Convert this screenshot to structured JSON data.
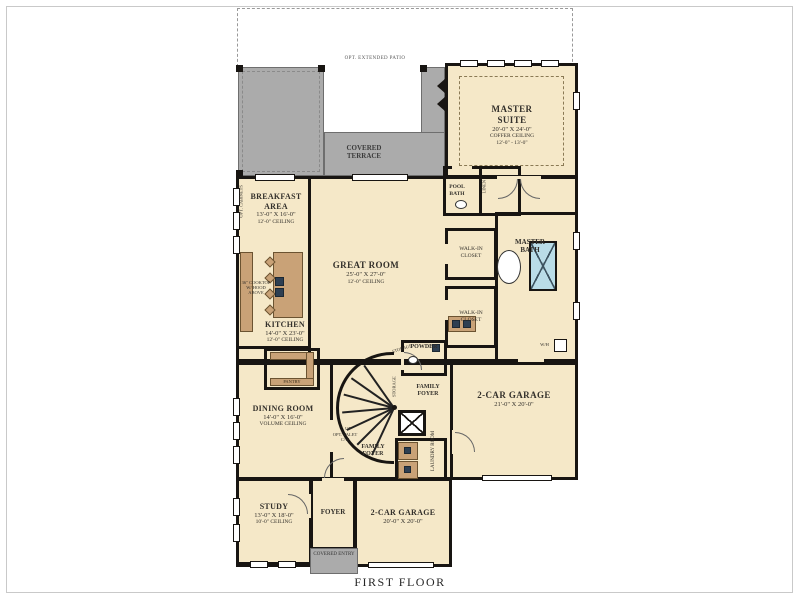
{
  "title": "FIRST FLOOR",
  "colors": {
    "room_fill": "#f5e8c8",
    "terrace_gray": "#ababab",
    "wall": "#181512",
    "cabinet_brown": "#c9a277",
    "water_blue": "#b9dce7"
  },
  "outdoor": {
    "opt_patio": "OPT. EXTENDED PATIO",
    "covered_terrace": "COVERED TERRACE",
    "covered_entry": "COVERED ENTRY"
  },
  "rooms": {
    "master_suite": {
      "name": "MASTER SUITE",
      "dims": "20'-0\" X 24'-0\"",
      "note1": "COFFER CEILING",
      "note2": "12'-0\" - 13'-0\""
    },
    "breakfast": {
      "name": "BREAKFAST AREA",
      "dims": "13'-0\" X 16'-0\"",
      "note": "12'-0\" CEILING"
    },
    "great_room": {
      "name": "GREAT ROOM",
      "dims": "25'-0\" X 27'-0\"",
      "note": "12'-0\" CEILING"
    },
    "kitchen": {
      "name": "KITCHEN",
      "dims": "14'-0\" X 23'-0\"",
      "note": "12'-0\" CEILING"
    },
    "dining": {
      "name": "DINING ROOM",
      "dims": "14'-0\" X 16'-0\"",
      "note": "VOLUME CEILING"
    },
    "study": {
      "name": "STUDY",
      "dims": "13'-0\" X 18'-0\"",
      "note": "10'-0\" CEILING"
    },
    "garage_right": {
      "name": "2-CAR GARAGE",
      "dims": "21'-0\" X 20'-0\""
    },
    "garage_bottom": {
      "name": "2-CAR GARAGE",
      "dims": "20'-0\" X 20'-0\""
    },
    "master_bath": {
      "name": "MASTER BATH"
    },
    "pool_bath": {
      "name": "POOL BATH"
    },
    "powder": {
      "name": "POWDER"
    },
    "foyer": {
      "name": "FOYER"
    },
    "family_foyer": {
      "name": "FAMILY FOYER"
    },
    "laundry": {
      "name": "LAUNDRY ROOM"
    },
    "walk_in_closet": {
      "name": "WALK-IN CLOSET"
    },
    "pantry": {
      "name": "PANTRY"
    },
    "linen": {
      "name": "LINEN"
    },
    "storage": {
      "name": "STORAGE"
    }
  },
  "annotations": {
    "up": "UP",
    "wh": "W/H",
    "cooktop": "36\" COOKTOP W/ HOOD ABOVE",
    "opt_cabinets": "OPT. CABINETS",
    "opt_valet": "OPT. VALET C/W"
  }
}
